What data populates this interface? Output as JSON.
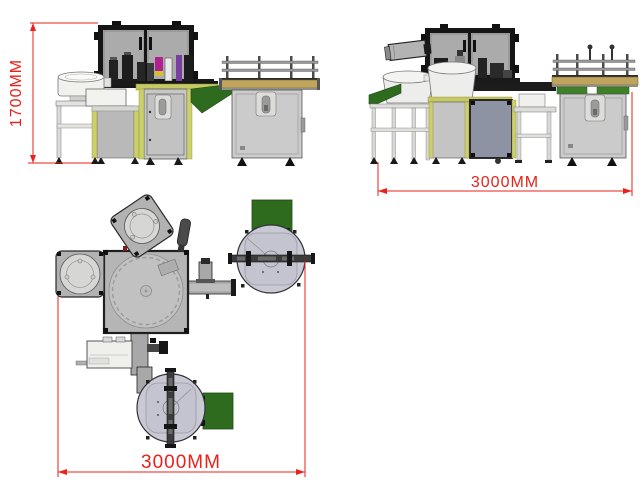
{
  "drawing": {
    "views": {
      "front": {
        "dimension_label": "1700MM"
      },
      "side": {
        "dimension_label": "3000MM"
      },
      "plan": {
        "dimension_label": "3000MM"
      }
    },
    "colors": {
      "dimension_red": "#e8221a",
      "frame_black": "#151515",
      "enclosure_panel_gray": "#a9a9a9",
      "cabinet_gray": "#c9c9c9",
      "cabinet_blue_gray": "#8e93a4",
      "bowl_feeder_white": "#f2f2f0",
      "frame_strip_olive": "#c6c963",
      "conveyor_belt_tan": "#bfa45e",
      "chute_green": "#2e6b1f",
      "turntable_gray": "#c9c9d4",
      "accent_magenta": "#b02090",
      "accent_purple": "#7a3fa0",
      "accent_yellow": "#d4c22a"
    }
  }
}
